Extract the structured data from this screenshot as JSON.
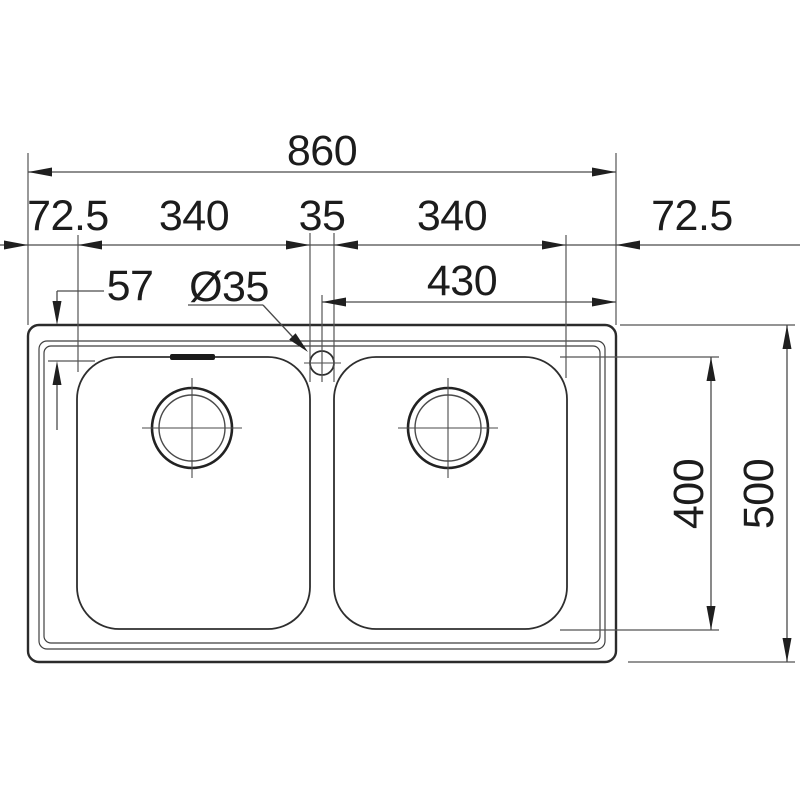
{
  "drawing": {
    "subject": "double-bowl-sink-top-view",
    "colors": {
      "background": "#ffffff",
      "line": "#3f3f3f",
      "outline": "#2b2b2b",
      "text": "#1c1c1c"
    },
    "dimensions": {
      "overall_width": "860",
      "left_margin": "72.5",
      "left_bowl_width": "340",
      "bowl_gap": "35",
      "right_bowl_width": "340",
      "right_margin": "72.5",
      "tap_hole_diameter": "Ø35",
      "rim_to_bowl_top": "57",
      "centre_to_right_edge": "430",
      "bowl_front_to_back": "400",
      "overall_depth": "500"
    }
  }
}
